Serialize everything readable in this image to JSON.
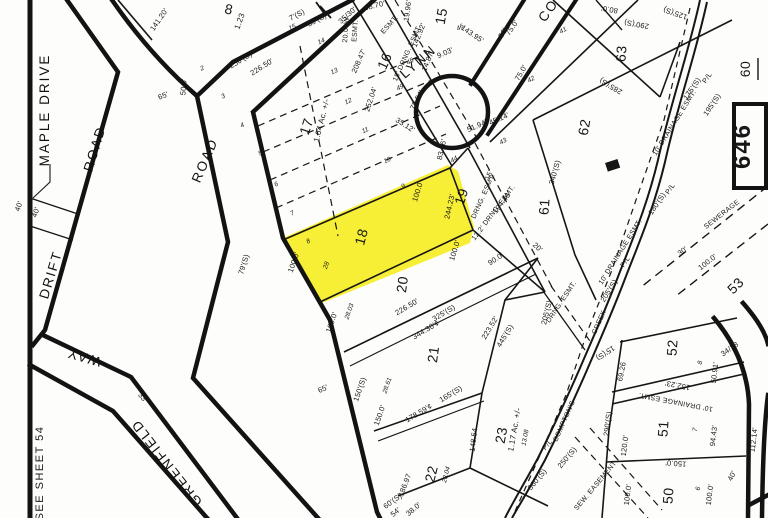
{
  "map": {
    "kind": "assessor plat map (scanned)",
    "highlighted_lot": "18",
    "highlight_color": "#F6EC13",
    "line_color": "#161616",
    "background_color": "#fdfdfb",
    "sheet_number_box": "646",
    "label_groups": [
      {
        "name": "roads",
        "class": "road-label",
        "items": [
          {
            "t": "MAPLE  DRIVE",
            "x": 49,
            "y": 110,
            "r": -90
          },
          {
            "t": "DRIFT",
            "x": 55,
            "y": 276,
            "r": -73
          },
          {
            "t": "ROAD",
            "x": 99,
            "y": 150,
            "r": -73
          },
          {
            "t": "ROAD",
            "x": 209,
            "y": 162,
            "r": -67
          },
          {
            "t": "WAY",
            "x": 85,
            "y": 353,
            "r": 196
          },
          {
            "t": "GREENFIELD",
            "x": 170,
            "y": 460,
            "r": 232
          },
          {
            "t": "LYNN",
            "x": 421,
            "y": 65,
            "r": -41
          },
          {
            "t": "CO",
            "x": 552,
            "y": 13,
            "r": -55
          }
        ]
      },
      {
        "name": "lots",
        "class": "lot-label",
        "items": [
          {
            "t": "8",
            "x": 228,
            "y": 14,
            "r": 12,
            "s": 13
          },
          {
            "t": "15",
            "x": 446,
            "y": 17,
            "r": -80,
            "s": 13
          },
          {
            "t": "16",
            "x": 389,
            "y": 63,
            "r": -66,
            "s": 13
          },
          {
            "t": "17",
            "x": 311,
            "y": 128,
            "r": -72,
            "s": 14
          },
          {
            "t": "18",
            "x": 366,
            "y": 238,
            "r": -75,
            "s": 16
          },
          {
            "t": "19",
            "x": 466,
            "y": 198,
            "r": -72,
            "s": 13
          },
          {
            "t": "20",
            "x": 407,
            "y": 285,
            "r": -82,
            "s": 14
          },
          {
            "t": "21",
            "x": 438,
            "y": 355,
            "r": -82,
            "s": 14
          },
          {
            "t": "22",
            "x": 436,
            "y": 475,
            "r": -76,
            "s": 13
          },
          {
            "t": "23",
            "x": 506,
            "y": 436,
            "r": -80,
            "s": 13
          },
          {
            "t": "50",
            "x": 673,
            "y": 496,
            "r": -86,
            "s": 14
          },
          {
            "t": "51",
            "x": 668,
            "y": 429,
            "r": -86,
            "s": 14
          },
          {
            "t": "52",
            "x": 677,
            "y": 348,
            "r": -86,
            "s": 14
          },
          {
            "t": "53",
            "x": 739,
            "y": 289,
            "r": -45,
            "s": 13
          },
          {
            "t": "60",
            "x": 750,
            "y": 69,
            "r": -90,
            "s": 13
          },
          {
            "t": "61",
            "x": 549,
            "y": 207,
            "r": -86,
            "s": 13
          },
          {
            "t": "62",
            "x": 589,
            "y": 128,
            "r": -80,
            "s": 14
          },
          {
            "t": "63",
            "x": 626,
            "y": 54,
            "r": -86,
            "s": 14
          }
        ]
      },
      {
        "name": "acreages",
        "class": "acre-label",
        "items": [
          {
            "t": "1.23",
            "x": 242,
            "y": 22,
            "r": -70
          },
          {
            "t": "1.64  Ac.  +/-",
            "x": 324,
            "y": 121,
            "r": -76
          },
          {
            "t": "1.17  Ac.  +/-",
            "x": 517,
            "y": 430,
            "r": -80
          }
        ]
      },
      {
        "name": "dimensions",
        "class": "dim-label",
        "items": [
          {
            "t": "141.20'",
            "x": 161,
            "y": 21,
            "r": -55
          },
          {
            "t": "50.0'",
            "x": 186,
            "y": 87,
            "r": -86
          },
          {
            "t": "65'",
            "x": 164,
            "y": 98,
            "r": -20
          },
          {
            "t": "65'",
            "x": 324,
            "y": 391,
            "r": -25
          },
          {
            "t": "40'",
            "x": 21,
            "y": 207,
            "r": -70
          },
          {
            "t": "40'",
            "x": 38,
            "y": 213,
            "r": -70
          },
          {
            "t": "33'",
            "x": 141,
            "y": 399,
            "r": 50
          },
          {
            "t": "79'(S)",
            "x": 246,
            "y": 265,
            "r": -73
          },
          {
            "t": "100.0'",
            "x": 296,
            "y": 263,
            "r": -71
          },
          {
            "t": "100.0'",
            "x": 420,
            "y": 192,
            "r": -73
          },
          {
            "t": "100.0'",
            "x": 457,
            "y": 251,
            "r": -73
          },
          {
            "t": "100.0'",
            "x": 334,
            "y": 323,
            "r": -71
          },
          {
            "t": "244.23'",
            "x": 452,
            "y": 207,
            "r": -77
          },
          {
            "t": "250'(S)",
            "x": 242,
            "y": 62,
            "r": -32
          },
          {
            "t": "226.50'",
            "x": 263,
            "y": 69,
            "r": -32
          },
          {
            "t": "7'(S)",
            "x": 298,
            "y": 17,
            "r": -28
          },
          {
            "t": "35'(S)",
            "x": 318,
            "y": 22,
            "r": -28
          },
          {
            "t": "35/30'",
            "x": 349,
            "y": 17,
            "r": -42
          },
          {
            "t": "68.70'",
            "x": 375,
            "y": 8,
            "r": -14
          },
          {
            "t": "19.96'",
            "x": 410,
            "y": 11,
            "r": -82
          },
          {
            "t": "208.47'",
            "x": 361,
            "y": 62,
            "r": -66
          },
          {
            "t": "252.04'",
            "x": 373,
            "y": 100,
            "r": -72
          },
          {
            "t": "142.92'",
            "x": 421,
            "y": 36,
            "r": -68
          },
          {
            "t": "14.87'",
            "x": 430,
            "y": 62,
            "r": -68
          },
          {
            "t": "9.03'",
            "x": 446,
            "y": 55,
            "r": -24
          },
          {
            "t": "143.95'",
            "x": 471,
            "y": 36,
            "r": 34
          },
          {
            "t": "78.54'",
            "x": 419,
            "y": 101,
            "r": -63
          },
          {
            "t": "35.12'",
            "x": 404,
            "y": 127,
            "r": 32
          },
          {
            "t": "83.36'",
            "x": 444,
            "y": 150,
            "r": -77
          },
          {
            "t": "51.94'",
            "x": 478,
            "y": 128,
            "r": -24
          },
          {
            "t": "45.14'",
            "x": 500,
            "y": 121,
            "r": -24
          },
          {
            "t": "75.0'",
            "x": 514,
            "y": 29,
            "r": -56
          },
          {
            "t": "75.0'",
            "x": 523,
            "y": 74,
            "r": -60
          },
          {
            "t": "50'",
            "x": 505,
            "y": 34,
            "r": -60
          },
          {
            "t": "90.0'",
            "x": 497,
            "y": 261,
            "r": -33
          },
          {
            "t": "20'",
            "x": 536,
            "y": 249,
            "r": 42
          },
          {
            "t": "340'(S)",
            "x": 557,
            "y": 173,
            "r": -74
          },
          {
            "t": "285'(S)",
            "x": 612,
            "y": 84,
            "r": 211
          },
          {
            "t": "290'(S)",
            "x": 637,
            "y": 22,
            "r": 190
          },
          {
            "t": "125'(S)",
            "x": 676,
            "y": 11,
            "r": 199
          },
          {
            "t": "80.0'",
            "x": 610,
            "y": 7,
            "r": 190
          },
          {
            "t": "175'(S)",
            "x": 694,
            "y": 90,
            "r": -56
          },
          {
            "t": "195'(S)",
            "x": 714,
            "y": 106,
            "r": -56
          },
          {
            "t": "180'(S)",
            "x": 659,
            "y": 205,
            "r": -56
          },
          {
            "t": "205'(S)",
            "x": 611,
            "y": 292,
            "r": -58
          },
          {
            "t": "205'(S)",
            "x": 549,
            "y": 313,
            "r": -76
          },
          {
            "t": "226.50'",
            "x": 408,
            "y": 309,
            "r": -31
          },
          {
            "t": "325'(S)",
            "x": 445,
            "y": 315,
            "r": -31
          },
          {
            "t": "344.30'¢",
            "x": 427,
            "y": 332,
            "r": -31
          },
          {
            "t": "223.52'",
            "x": 492,
            "y": 329,
            "r": -59
          },
          {
            "t": "445'(S)",
            "x": 507,
            "y": 337,
            "r": -59
          },
          {
            "t": "165'(S)",
            "x": 452,
            "y": 396,
            "r": -31
          },
          {
            "t": "178.59'¢",
            "x": 420,
            "y": 415,
            "r": -31
          },
          {
            "t": "148.54",
            "x": 476,
            "y": 440,
            "r": -83
          },
          {
            "t": "150'(S)",
            "x": 362,
            "y": 390,
            "r": -71
          },
          {
            "t": "150.0'",
            "x": 382,
            "y": 416,
            "r": -71
          },
          {
            "t": "186.97",
            "x": 407,
            "y": 486,
            "r": -69
          },
          {
            "t": "60'(S)",
            "x": 394,
            "y": 503,
            "r": -36
          },
          {
            "t": "360'(S)",
            "x": 539,
            "y": 481,
            "r": -50
          },
          {
            "t": "250'(S)",
            "x": 569,
            "y": 459,
            "r": -50
          },
          {
            "t": "194.46'",
            "x": 504,
            "y": 204,
            "r": -53
          },
          {
            "t": "152.23'",
            "x": 678,
            "y": 383,
            "r": 191
          },
          {
            "t": "69.26",
            "x": 624,
            "y": 372,
            "r": -79
          },
          {
            "t": "15'(S)",
            "x": 604,
            "y": 351,
            "r": 146
          },
          {
            "t": "290'(S)",
            "x": 610,
            "y": 424,
            "r": -83
          },
          {
            "t": "120.0'",
            "x": 627,
            "y": 446,
            "r": -83
          },
          {
            "t": "150.0'",
            "x": 676,
            "y": 461,
            "r": 184
          },
          {
            "t": "100.0'",
            "x": 630,
            "y": 495,
            "r": -83
          },
          {
            "t": "100.0'",
            "x": 712,
            "y": 495,
            "r": -83
          },
          {
            "t": "94.43'",
            "x": 716,
            "y": 436,
            "r": -83
          },
          {
            "t": "50.91'",
            "x": 717,
            "y": 373,
            "r": -83
          },
          {
            "t": "112.14'",
            "x": 756,
            "y": 440,
            "r": -83
          },
          {
            "t": "40'",
            "x": 734,
            "y": 477,
            "r": -62
          },
          {
            "t": "34/28",
            "x": 731,
            "y": 351,
            "r": -35
          },
          {
            "t": "30'",
            "x": 684,
            "y": 253,
            "r": -38
          },
          {
            "t": "100.0'",
            "x": 709,
            "y": 264,
            "r": -38
          },
          {
            "t": "54'",
            "x": 397,
            "y": 514,
            "r": -40
          },
          {
            "t": "38.0'",
            "x": 415,
            "y": 511,
            "r": -40
          }
        ]
      },
      {
        "name": "easements",
        "class": "ease-label",
        "items": [
          {
            "t": "20.0' W.",
            "x": 348,
            "y": 29,
            "r": -86
          },
          {
            "t": "ESMT.",
            "x": 357,
            "y": 31,
            "r": -86
          },
          {
            "t": "ESMT.",
            "x": 391,
            "y": 26,
            "r": -48
          },
          {
            "t": "15' DRNG. ESMT.",
            "x": 409,
            "y": 54,
            "r": -66
          },
          {
            "t": "15'",
            "x": 491,
            "y": 176,
            "r": -66
          },
          {
            "t": "DRNG. ESMT.",
            "x": 485,
            "y": 197,
            "r": -66
          },
          {
            "t": "12.2' DRNG. ESMT.",
            "x": 495,
            "y": 214,
            "r": -53
          },
          {
            "t": "DRNG. ESMT.",
            "x": 563,
            "y": 303,
            "r": -56
          },
          {
            "t": "10' DRAINAGE ESMT.",
            "x": 676,
            "y": 124,
            "r": -58
          },
          {
            "t": "10' DRAINAGE ESMT.",
            "x": 622,
            "y": 253,
            "r": -58
          },
          {
            "t": "10' DRAINAGE ESMT.",
            "x": 676,
            "y": 400,
            "r": 191
          },
          {
            "t": "SEWERAGE",
            "x": 723,
            "y": 216,
            "r": -38
          },
          {
            "t": "SEW. EASEMENT",
            "x": 597,
            "y": 487,
            "r": -50
          },
          {
            "t": "P/L",
            "x": 672,
            "y": 190,
            "r": -56
          },
          {
            "t": "P/L",
            "x": 627,
            "y": 263,
            "r": -56
          },
          {
            "t": "P/L",
            "x": 549,
            "y": 446,
            "r": -50
          },
          {
            "t": "P/L",
            "x": 709,
            "y": 79,
            "r": -56
          },
          {
            "t": "COMPTON'S",
            "x": 566,
            "y": 422,
            "r": -66
          },
          {
            "t": "CREEK",
            "x": 601,
            "y": 323,
            "r": -66
          }
        ]
      },
      {
        "name": "point_numbers",
        "class": "small-label",
        "items": [
          {
            "t": "2",
            "x": 203,
            "y": 70,
            "r": -25
          },
          {
            "t": "3",
            "x": 224,
            "y": 98,
            "r": -25
          },
          {
            "t": "4",
            "x": 243,
            "y": 127,
            "r": -25
          },
          {
            "t": "5",
            "x": 261,
            "y": 155,
            "r": -25
          },
          {
            "t": "6",
            "x": 277,
            "y": 186,
            "r": -25
          },
          {
            "t": "7",
            "x": 293,
            "y": 215,
            "r": -25
          },
          {
            "t": "8",
            "x": 309,
            "y": 243,
            "r": -25
          },
          {
            "t": "9",
            "x": 404,
            "y": 188,
            "r": -25
          },
          {
            "t": "10",
            "x": 388,
            "y": 162,
            "r": -25
          },
          {
            "t": "11",
            "x": 366,
            "y": 132,
            "r": -25
          },
          {
            "t": "12",
            "x": 349,
            "y": 103,
            "r": -25
          },
          {
            "t": "13",
            "x": 335,
            "y": 73,
            "r": -25
          },
          {
            "t": "14",
            "x": 322,
            "y": 43,
            "r": -25
          },
          {
            "t": "15",
            "x": 293,
            "y": 29,
            "r": -25
          },
          {
            "t": "28",
            "x": 328,
            "y": 266,
            "r": -70
          },
          {
            "t": "41",
            "x": 564,
            "y": 32,
            "r": -30
          },
          {
            "t": "42",
            "x": 532,
            "y": 81,
            "r": -30
          },
          {
            "t": "43",
            "x": 504,
            "y": 143,
            "r": -30
          },
          {
            "t": "44",
            "x": 455,
            "y": 161,
            "r": -30
          },
          {
            "t": "45",
            "x": 411,
            "y": 63,
            "r": -30
          },
          {
            "t": "46",
            "x": 461,
            "y": 29,
            "r": -30
          },
          {
            "t": "49",
            "x": 401,
            "y": 89,
            "r": -30
          },
          {
            "t": "28.61",
            "x": 389,
            "y": 386,
            "r": -71
          },
          {
            "t": "28.03",
            "x": 351,
            "y": 312,
            "r": -71
          },
          {
            "t": "28.04",
            "x": 448,
            "y": 475,
            "r": -76
          },
          {
            "t": "13.08",
            "x": 527,
            "y": 438,
            "r": -79
          },
          {
            "t": "7",
            "x": 697,
            "y": 430,
            "r": -80
          },
          {
            "t": "8",
            "x": 702,
            "y": 363,
            "r": -80
          },
          {
            "t": "6",
            "x": 700,
            "y": 489,
            "r": -80
          }
        ]
      },
      {
        "name": "sheet_refs",
        "class": "sheet-label",
        "items": [
          {
            "t": "SEE  SHEET  54",
            "x": 43,
            "y": 473,
            "r": -90
          }
        ]
      },
      {
        "name": "sheet_number",
        "class": "big-label",
        "items": [
          {
            "t": "646",
            "x": 750,
            "y": 146,
            "r": -90
          }
        ]
      }
    ]
  }
}
